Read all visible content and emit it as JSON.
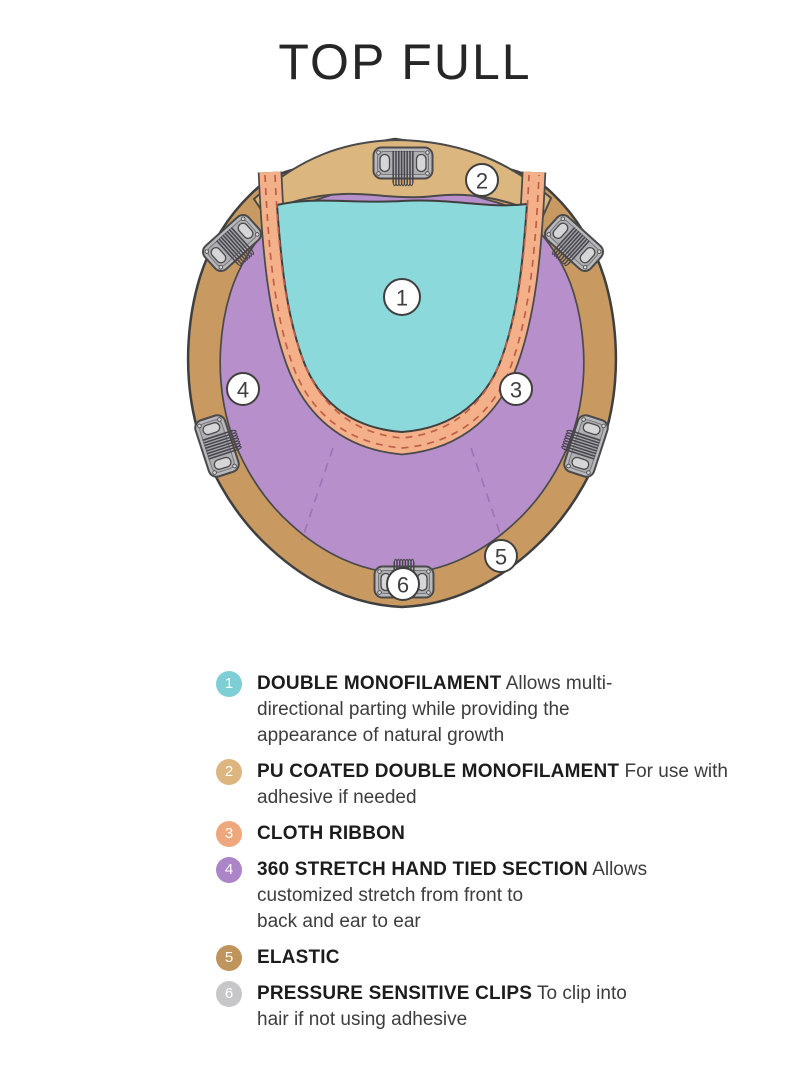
{
  "title": "TOP FULL",
  "diagram": {
    "callouts": [
      "1",
      "2",
      "3",
      "4",
      "5",
      "6"
    ]
  },
  "legend": {
    "items": [
      {
        "number": "1",
        "badge_color": "#7dced5",
        "title": "DOUBLE MONOFILAMENT",
        "lines": [
          "Allows multi-",
          "directional parting while providing the",
          "appearance of natural growth"
        ]
      },
      {
        "number": "2",
        "badge_color": "#dcb67e",
        "title": "PU COATED DOUBLE MONOFILAMENT",
        "lines": [
          "For use with adhesive if needed"
        ]
      },
      {
        "number": "3",
        "badge_color": "#efa87d",
        "title": "CLOTH RIBBON",
        "lines": []
      },
      {
        "number": "4",
        "badge_color": "#ab85c8",
        "title": "360 STRETCH HAND TIED SECTION",
        "lines": [
          "Allows",
          "customized stretch from front to",
          "back and ear to ear"
        ]
      },
      {
        "number": "5",
        "badge_color": "#bf945d",
        "title": "ELASTIC",
        "lines": []
      },
      {
        "number": "6",
        "badge_color": "#c7c7c9",
        "title": "PRESSURE SENSITIVE CLIPS",
        "lines": [
          "To clip into",
          "hair if not using adhesive"
        ]
      }
    ]
  },
  "colors": {
    "outer_band_tan": "#c89a62",
    "top_band_tan": "#dcb67f",
    "monofilament_teal": "#8bd9da",
    "hand_tied_purple": "#b78fcb",
    "ribbon_peach": "#f3b089",
    "stitch_dash": "#bf5f49",
    "seam_dash": "#9a74b4",
    "clip_gray": "#b9b9bd",
    "outline": "#3f3f3f"
  }
}
